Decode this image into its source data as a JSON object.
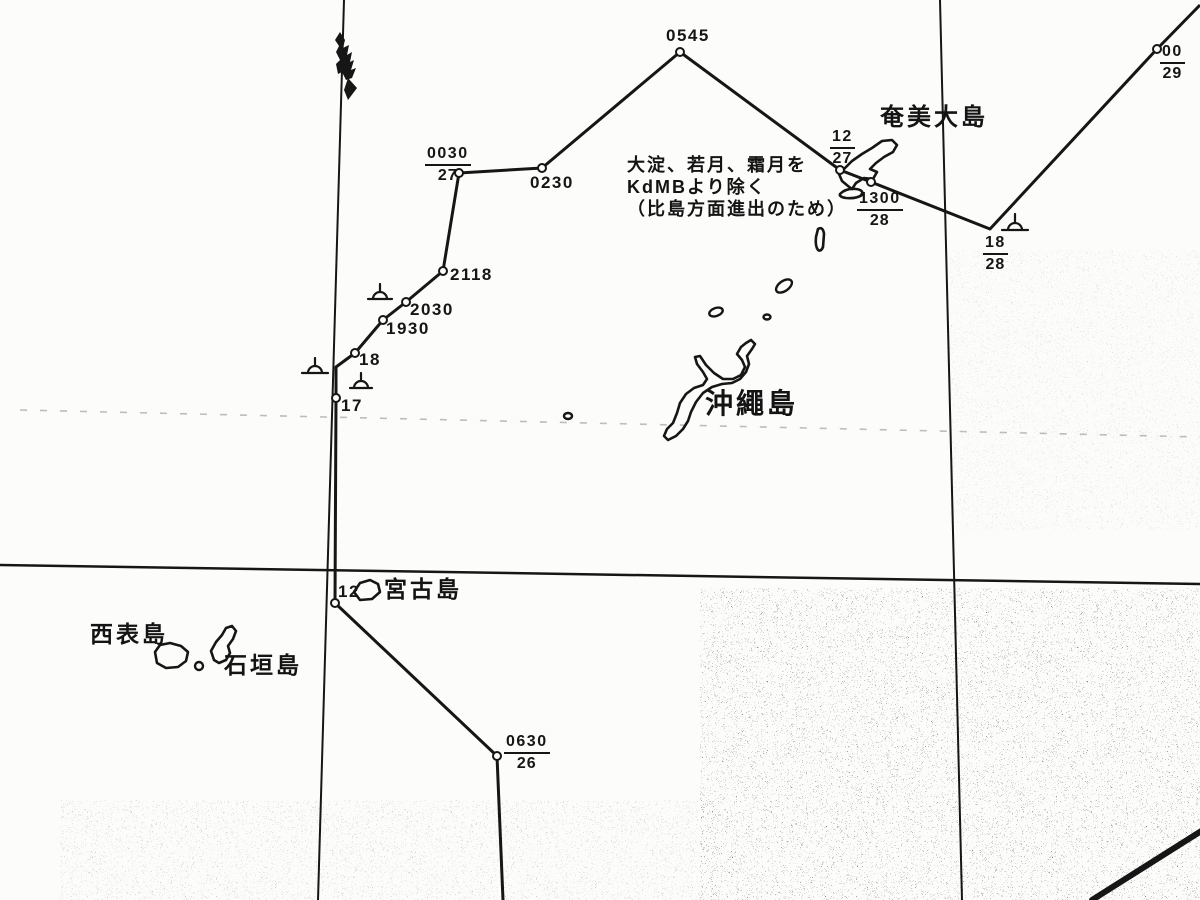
{
  "colors": {
    "ink": "#161616",
    "bg": "#fcfcfa",
    "faint": "#8a8a84"
  },
  "grid": {
    "verticals": [
      [
        344,
        0,
        318,
        900
      ],
      [
        940,
        0,
        962,
        900
      ]
    ],
    "horizontals": [
      [
        0,
        565,
        1200,
        584
      ]
    ],
    "dashed": [
      [
        20,
        410,
        1200,
        437
      ]
    ]
  },
  "track": {
    "points": [
      [
        503,
        900
      ],
      [
        497,
        756
      ],
      [
        335,
        603
      ],
      [
        336,
        398
      ],
      [
        336,
        367
      ],
      [
        355,
        353
      ],
      [
        383,
        320
      ],
      [
        406,
        302
      ],
      [
        443,
        271
      ],
      [
        459,
        173
      ],
      [
        542,
        168
      ],
      [
        680,
        52
      ],
      [
        840,
        170
      ],
      [
        871,
        182
      ],
      [
        990,
        229
      ],
      [
        1157,
        49
      ],
      [
        1200,
        5
      ]
    ],
    "waypoint_circles": [
      [
        497,
        756
      ],
      [
        335,
        603
      ],
      [
        336,
        398
      ],
      [
        355,
        353
      ],
      [
        383,
        320
      ],
      [
        406,
        302
      ],
      [
        443,
        271
      ],
      [
        459,
        173
      ],
      [
        542,
        168
      ],
      [
        680,
        52
      ],
      [
        840,
        170
      ],
      [
        871,
        182
      ],
      [
        1157,
        49
      ]
    ]
  },
  "time_labels": {
    "plain": [
      {
        "id": "0545",
        "text": "0545",
        "x": 666,
        "y": 27
      },
      {
        "id": "0230",
        "text": "0230",
        "x": 530,
        "y": 174
      },
      {
        "id": "2118",
        "text": "2118",
        "x": 450,
        "y": 266
      },
      {
        "id": "2030",
        "text": "2030",
        "x": 410,
        "y": 301
      },
      {
        "id": "1930",
        "text": "1930",
        "x": 386,
        "y": 320
      },
      {
        "id": "18",
        "text": "18",
        "x": 359,
        "y": 351
      },
      {
        "id": "17",
        "text": "17",
        "x": 341,
        "y": 397
      },
      {
        "id": "12",
        "text": "12",
        "x": 338,
        "y": 583
      }
    ],
    "fractions": [
      {
        "id": "0030-27",
        "num": "0030",
        "den": "27",
        "x": 425,
        "y": 146
      },
      {
        "id": "0630-26",
        "num": "0630",
        "den": "26",
        "x": 504,
        "y": 734
      },
      {
        "id": "12-27",
        "num": "12",
        "den": "27",
        "x": 830,
        "y": 129
      },
      {
        "id": "1300-28",
        "num": "1300",
        "den": "28",
        "x": 857,
        "y": 191
      },
      {
        "id": "18-28",
        "num": "18",
        "den": "28",
        "x": 983,
        "y": 235
      },
      {
        "id": "00-29",
        "num": "00",
        "den": "29",
        "x": 1160,
        "y": 44
      }
    ]
  },
  "islands": {
    "labels": [
      {
        "id": "amami-oshima",
        "text": "奄美大島",
        "x": 880,
        "y": 106,
        "size": 24
      },
      {
        "id": "okinawa",
        "text": "沖繩島",
        "x": 705,
        "y": 390,
        "size": 28
      },
      {
        "id": "miyako",
        "text": "宮古島",
        "x": 384,
        "y": 578,
        "size": 23
      },
      {
        "id": "iriomote",
        "text": "西表島",
        "x": 90,
        "y": 623,
        "size": 23
      },
      {
        "id": "ishigaki",
        "text": "石垣島",
        "x": 224,
        "y": 654,
        "size": 23
      }
    ],
    "outlines": [
      {
        "id": "okinawa",
        "d": "M751,340 L746,343 L741,347 L737,354 L742,360 L745,367 L741,375 L733,379 L723,379 L714,373 L706,365 L700,356 L695,357 L697,364 L703,372 L707,379 L703,385 L694,388 L686,394 L680,403 L677,413 L673,423 L667,429 L664,436 L668,440 L676,436 L683,429 L688,421 L691,412 L696,402 L703,393 L712,387 L722,384 L732,383 L740,379 L746,372 L749,364 L747,356 L752,349 L755,344 Z"
      },
      {
        "id": "amami-oshima",
        "d": "M848,186 L842,181 L839,174 L845,168 L852,161 L862,154 L872,148 L882,141 L892,140 L897,145 L893,152 L884,157 L876,163 L870,169 L877,172 L873,179 L864,178 L856,183 L852,189 Z"
      },
      {
        "id": "amami-islet",
        "d": "M840,194 Q846,188 856,189 Q864,190 862,195 Q856,199 846,198 Q839,197 840,194 Z"
      },
      {
        "id": "amami-islet-long",
        "d": "M818,229 Q823,226 824,234 L823,247 Q821,252 818,250 Q815,246 816,237 Z"
      },
      {
        "id": "miyako",
        "d": "M354,592 L360,583 L370,580 L378,584 L380,592 L372,599 L360,600 Z"
      },
      {
        "id": "iriomote",
        "d": "M155,652 L160,645 L170,643 L181,646 L188,652 L186,661 L178,667 L166,668 L157,663 Z"
      },
      {
        "id": "ishigaki",
        "d": "M214,660 L211,651 L216,642 L222,635 L226,628 L232,626 L236,631 L233,639 L228,646 L230,653 L226,660 L219,663 Z"
      }
    ],
    "islets": [
      {
        "cx": 784,
        "cy": 286,
        "rx": 9,
        "ry": 5,
        "rot": -35
      },
      {
        "cx": 716,
        "cy": 312,
        "rx": 7,
        "ry": 4,
        "rot": -20
      },
      {
        "cx": 767,
        "cy": 317,
        "rx": 3.5,
        "ry": 2.5,
        "rot": 0
      },
      {
        "cx": 568,
        "cy": 416,
        "rx": 4,
        "ry": 3,
        "rot": 0
      },
      {
        "cx": 199,
        "cy": 666,
        "rx": 4,
        "ry": 4,
        "rot": 0
      }
    ]
  },
  "annotation": {
    "x": 627,
    "y": 154,
    "size": 18,
    "line_height": 22,
    "lines": [
      "大淀、若月、霜月を",
      "KdMBより除く",
      "（比島方面進出のため）"
    ]
  },
  "symbols": [
    {
      "cx": 380,
      "base_y": 299,
      "half_w": 12,
      "r": 7,
      "stick": 8
    },
    {
      "cx": 315,
      "base_y": 373,
      "half_w": 13,
      "r": 7,
      "stick": 8
    },
    {
      "cx": 361,
      "base_y": 388,
      "half_w": 11,
      "r": 7,
      "stick": 8
    },
    {
      "cx": 1015,
      "base_y": 230,
      "half_w": 13,
      "r": 7,
      "stick": 9
    }
  ],
  "artifacts": {
    "blot_paths": [
      "M340,32 L345,40 L343,48 L349,45 L347,55 L352,52 L350,62 L354,60 L351,70 L356,68 L352,78 L346,80 L342,72 L338,74 L336,64 L340,60 L336,52 L339,46 L335,40 Z",
      "M348,78 L357,88 L348,100 L344,90 Z"
    ],
    "crease": [
      1092,
      900,
      1206,
      828
    ],
    "speckle_regions": [
      {
        "x": 700,
        "y": 588,
        "w": 500,
        "h": 312,
        "o": 0.5
      },
      {
        "x": 60,
        "y": 800,
        "w": 660,
        "h": 100,
        "o": 0.25
      },
      {
        "x": 950,
        "y": 250,
        "w": 250,
        "h": 280,
        "o": 0.15
      }
    ]
  }
}
